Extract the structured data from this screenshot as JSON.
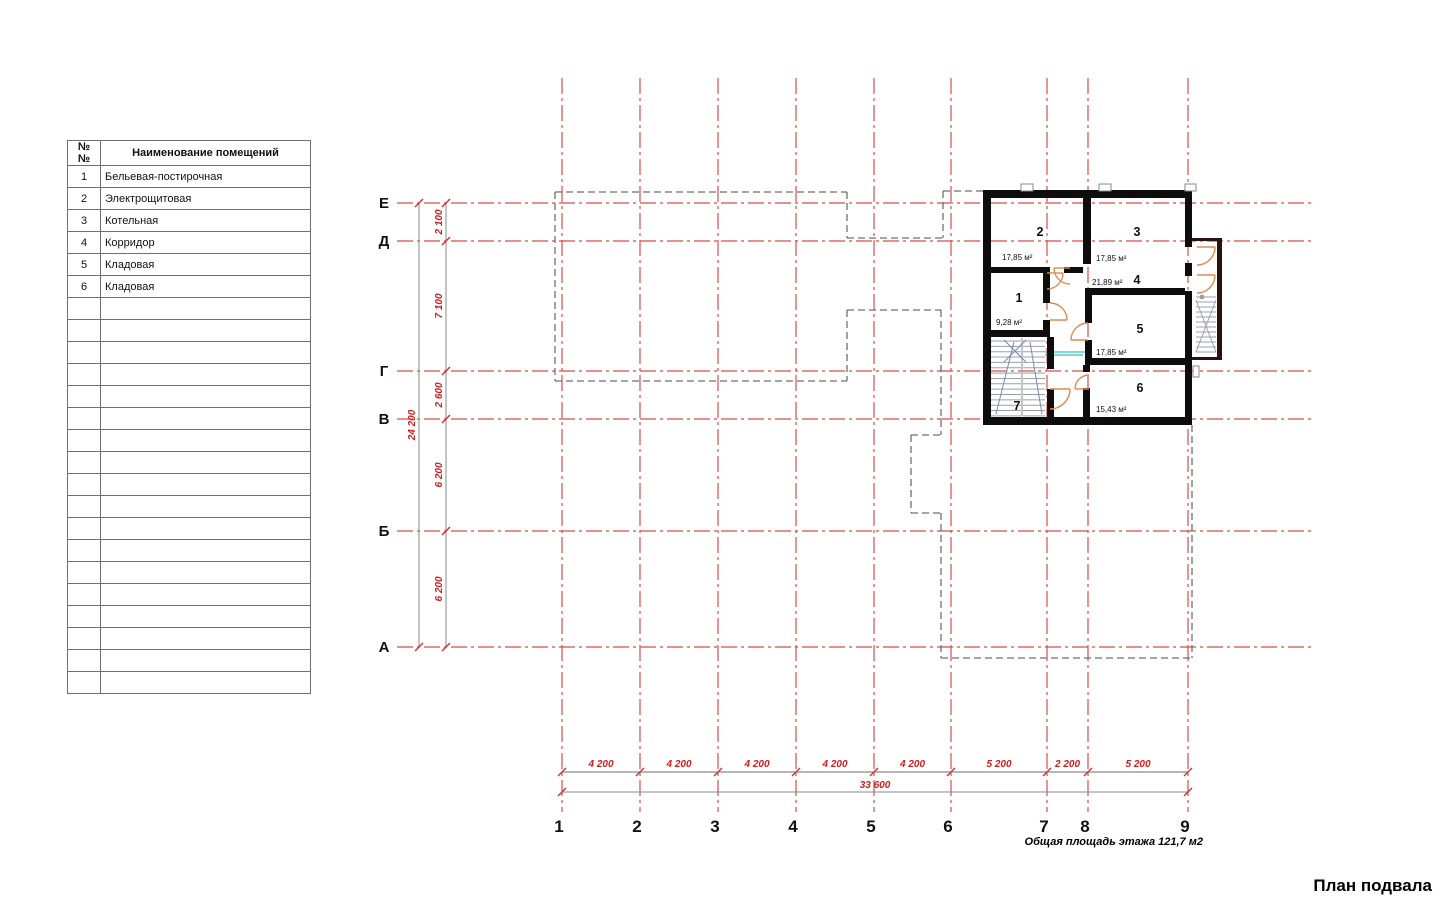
{
  "page": {
    "title": "План подвала",
    "total_area_label": "Общая площадь этажа 121,7 м2"
  },
  "colors": {
    "axis_red": "#d84c4c",
    "dim_text_red": "#cf1d1d",
    "tick_red": "#cf3333",
    "wall_black": "#0d0d0d",
    "stair_wall_dark": "#2a1212",
    "projection_gray": "#6f6f6f",
    "dim_line_gray": "#8a8a8a",
    "door_orange": "#e08a4e",
    "stair_tread_gray": "#9aa0a8",
    "stair_diag_blue": "#7c87b8",
    "teal": "#5ec8c8",
    "window_gray": "#888888",
    "label_black": "#111111"
  },
  "table": {
    "headers": [
      "№№",
      "Наименование помещений"
    ],
    "rows": [
      [
        "1",
        "Бельевая-постирочная"
      ],
      [
        "2",
        "Электрощитовая"
      ],
      [
        "3",
        "Котельная"
      ],
      [
        "4",
        "Корридор"
      ],
      [
        "5",
        "Кладовая"
      ],
      [
        "6",
        "Кладовая"
      ]
    ],
    "empty_row_count": 18
  },
  "plan": {
    "axes_vertical": [
      {
        "label": "1",
        "x": 562
      },
      {
        "label": "2",
        "x": 640
      },
      {
        "label": "3",
        "x": 718
      },
      {
        "label": "4",
        "x": 796
      },
      {
        "label": "5",
        "x": 874
      },
      {
        "label": "6",
        "x": 951
      },
      {
        "label": "7",
        "x": 1047
      },
      {
        "label": "8",
        "x": 1088
      },
      {
        "label": "9",
        "x": 1188
      }
    ],
    "axes_horizontal": [
      {
        "label": "Е",
        "y": 203
      },
      {
        "label": "Д",
        "y": 241
      },
      {
        "label": "Г",
        "y": 371
      },
      {
        "label": "В",
        "y": 419
      },
      {
        "label": "Б",
        "y": 531
      },
      {
        "label": "А",
        "y": 647
      }
    ],
    "extents": {
      "v_top": 78,
      "v_bottom": 812,
      "h_left": 397,
      "h_right": 1313,
      "axis_label_x": 384,
      "axis_label_y": 832
    },
    "dim_left": {
      "seg_line_x": 446,
      "total_line_x": 419,
      "from_y": 203,
      "to_y": 647,
      "segments": [
        {
          "text": "2 100",
          "from": 203,
          "to": 241
        },
        {
          "text": "7 100",
          "from": 241,
          "to": 371
        },
        {
          "text": "2 600",
          "from": 371,
          "to": 419
        },
        {
          "text": "6 200",
          "from": 419,
          "to": 531
        },
        {
          "text": "6 200",
          "from": 531,
          "to": 647
        }
      ],
      "total": {
        "text": "24 200"
      }
    },
    "dim_bottom": {
      "seg_line_y": 772,
      "total_line_y": 792,
      "from_x": 562,
      "to_x": 1188,
      "segments": [
        {
          "text": "4 200",
          "from": 562,
          "to": 640
        },
        {
          "text": "4 200",
          "from": 640,
          "to": 718
        },
        {
          "text": "4 200",
          "from": 718,
          "to": 796
        },
        {
          "text": "4 200",
          "from": 796,
          "to": 874
        },
        {
          "text": "4 200",
          "from": 874,
          "to": 951
        },
        {
          "text": "5 200",
          "from": 951,
          "to": 1047
        },
        {
          "text": "2 200",
          "from": 1047,
          "to": 1088
        },
        {
          "text": "5 200",
          "from": 1088,
          "to": 1188
        }
      ],
      "total": {
        "text": "33 600"
      }
    },
    "projection_segments": [
      [
        555,
        192,
        847,
        192
      ],
      [
        847,
        192,
        847,
        238
      ],
      [
        847,
        238,
        943,
        238
      ],
      [
        943,
        191,
        943,
        238
      ],
      [
        943,
        191,
        983,
        191
      ],
      [
        555,
        192,
        555,
        381
      ],
      [
        555,
        381,
        847,
        381
      ],
      [
        847,
        310,
        847,
        381
      ],
      [
        847,
        310,
        941,
        310
      ],
      [
        941,
        310,
        941,
        435
      ],
      [
        911,
        435,
        941,
        435
      ],
      [
        911,
        435,
        911,
        513
      ],
      [
        911,
        513,
        941,
        513
      ],
      [
        941,
        513,
        941,
        658
      ],
      [
        941,
        658,
        1192,
        658
      ],
      [
        1192,
        425,
        1192,
        658
      ]
    ],
    "walls": [
      [
        983,
        190,
        209,
        8
      ],
      [
        983,
        190,
        8,
        235
      ],
      [
        983,
        417,
        209,
        8
      ],
      [
        1185,
        190,
        7,
        57
      ],
      [
        1185,
        263,
        7,
        13
      ],
      [
        1185,
        291,
        7,
        134
      ],
      [
        1083,
        198,
        8,
        66
      ],
      [
        983,
        267,
        63,
        6
      ],
      [
        1064,
        267,
        19,
        6
      ],
      [
        1090,
        288,
        95,
        7
      ],
      [
        1085,
        288,
        7,
        35
      ],
      [
        1085,
        340,
        7,
        25
      ],
      [
        1085,
        358,
        107,
        7
      ],
      [
        1083,
        365,
        7,
        7
      ],
      [
        1083,
        388,
        7,
        37
      ],
      [
        1043,
        267,
        7,
        36
      ],
      [
        1043,
        320,
        7,
        17
      ],
      [
        983,
        330,
        67,
        7
      ],
      [
        1047,
        337,
        7,
        32
      ],
      [
        1047,
        389,
        7,
        36
      ]
    ],
    "stair_walls": [
      [
        1192,
        238,
        28,
        3
      ],
      [
        1217,
        238,
        5,
        122
      ],
      [
        1192,
        357,
        28,
        3
      ]
    ],
    "windows": [
      [
        1021,
        184,
        12,
        7
      ],
      [
        1099,
        184,
        12,
        7
      ],
      [
        1185,
        184,
        11,
        7
      ],
      [
        1193,
        366,
        6,
        11
      ]
    ],
    "doors": [
      {
        "h": [
          1047,
          273
        ],
        "s": [
          1063,
          273
        ],
        "e": [
          1047,
          289
        ],
        "sweep": 1
      },
      {
        "h": [
          1050,
          320
        ],
        "s": [
          1067,
          320
        ],
        "e": [
          1050,
          303
        ],
        "sweep": 0
      },
      {
        "h": [
          1088,
          340
        ],
        "s": [
          1071,
          340
        ],
        "e": [
          1088,
          323
        ],
        "sweep": 1
      },
      {
        "h": [
          1089,
          389
        ],
        "s": [
          1075,
          389
        ],
        "e": [
          1089,
          375
        ],
        "sweep": 1
      },
      {
        "h": [
          1050,
          389
        ],
        "s": [
          1070,
          389
        ],
        "e": [
          1050,
          409
        ],
        "sweep": 1
      },
      {
        "h": [
          1197,
          247
        ],
        "s": [
          1215,
          247
        ],
        "e": [
          1197,
          265
        ],
        "sweep": 1
      },
      {
        "h": [
          1197,
          275
        ],
        "s": [
          1215,
          275
        ],
        "e": [
          1197,
          293
        ],
        "sweep": 1
      },
      {
        "h": [
          1070,
          268
        ],
        "s": [
          1054,
          268
        ],
        "e": [
          1070,
          284
        ],
        "sweep": 0
      }
    ],
    "rooms": [
      {
        "num": "1",
        "nx": 1019,
        "ny": 302,
        "area": "9,28 м²",
        "ax": 996,
        "ay": 325
      },
      {
        "num": "2",
        "nx": 1040,
        "ny": 236,
        "area": "17,85 м²",
        "ax": 1002,
        "ay": 260
      },
      {
        "num": "3",
        "nx": 1137,
        "ny": 236,
        "area": "17,85 м²",
        "ax": 1096,
        "ay": 261
      },
      {
        "num": "4",
        "nx": 1137,
        "ny": 284,
        "area": "21,89 м²",
        "ax": 1092,
        "ay": 285
      },
      {
        "num": "5",
        "nx": 1140,
        "ny": 333,
        "area": "17,85 м²",
        "ax": 1096,
        "ay": 355
      },
      {
        "num": "6",
        "nx": 1140,
        "ny": 392,
        "area": "15,43 м²",
        "ax": 1096,
        "ay": 412
      },
      {
        "num": "7",
        "nx": 1017,
        "ny": 410,
        "area": "",
        "ax": 0,
        "ay": 0
      }
    ],
    "stairs": {
      "internal": {
        "left_x1": 991,
        "left_x2": 1021,
        "right_x1": 1023,
        "right_x2": 1045,
        "y1": 341,
        "y2": 416,
        "step": 5.35,
        "divider_x": 1022,
        "diag1": [
          996,
          414,
          1014,
          342
        ],
        "diag2": [
          1030,
          342,
          1042,
          414
        ],
        "x1": [
          1004,
          340,
          1026,
          362
        ],
        "x2": [
          1026,
          340,
          1004,
          362
        ]
      },
      "external": {
        "x1": 1196,
        "x2": 1216,
        "y1": 297,
        "y2": 355,
        "step": 5,
        "cross1": [
          1196,
          300,
          1216,
          352
        ],
        "cross2": [
          1216,
          300,
          1196,
          352
        ],
        "dot": [
          1202,
          297
        ]
      }
    },
    "teal_lines": [
      [
        1045,
        352,
        1090,
        352
      ],
      [
        1045,
        355,
        1083,
        355
      ]
    ]
  }
}
